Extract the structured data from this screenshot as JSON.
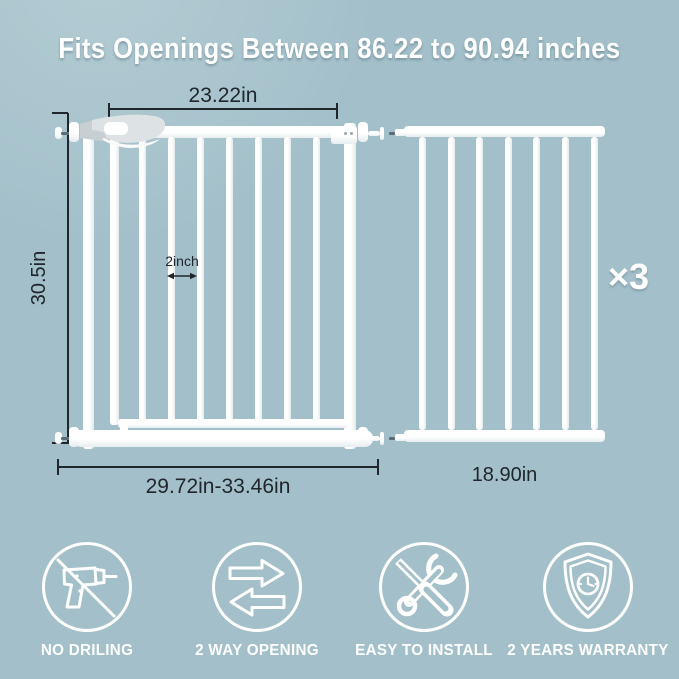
{
  "colors": {
    "background": "#a3c0ca",
    "metal_white": "#ffffff",
    "annotation_dark": "#20262c",
    "accent_white": "#ffffff"
  },
  "header": {
    "title": "Fits Openings Between 86.22 to 90.94 inches"
  },
  "diagram": {
    "gate": {
      "top_width_label": "23.22in",
      "height_label": "30.5in",
      "bar_gap_label": "2inch",
      "bottom_width_label": "29.72in-33.46in"
    },
    "extension": {
      "width_label": "18.90in",
      "quantity_label": "×3"
    }
  },
  "features": [
    {
      "icon": "no-drilling-icon",
      "label": "NO DRILING"
    },
    {
      "icon": "two-way-opening-icon",
      "label": "2 WAY OPENING"
    },
    {
      "icon": "easy-install-icon",
      "label": "EASY TO INSTALL"
    },
    {
      "icon": "warranty-shield-icon",
      "label": "2 YEARS WARRANTY"
    }
  ]
}
